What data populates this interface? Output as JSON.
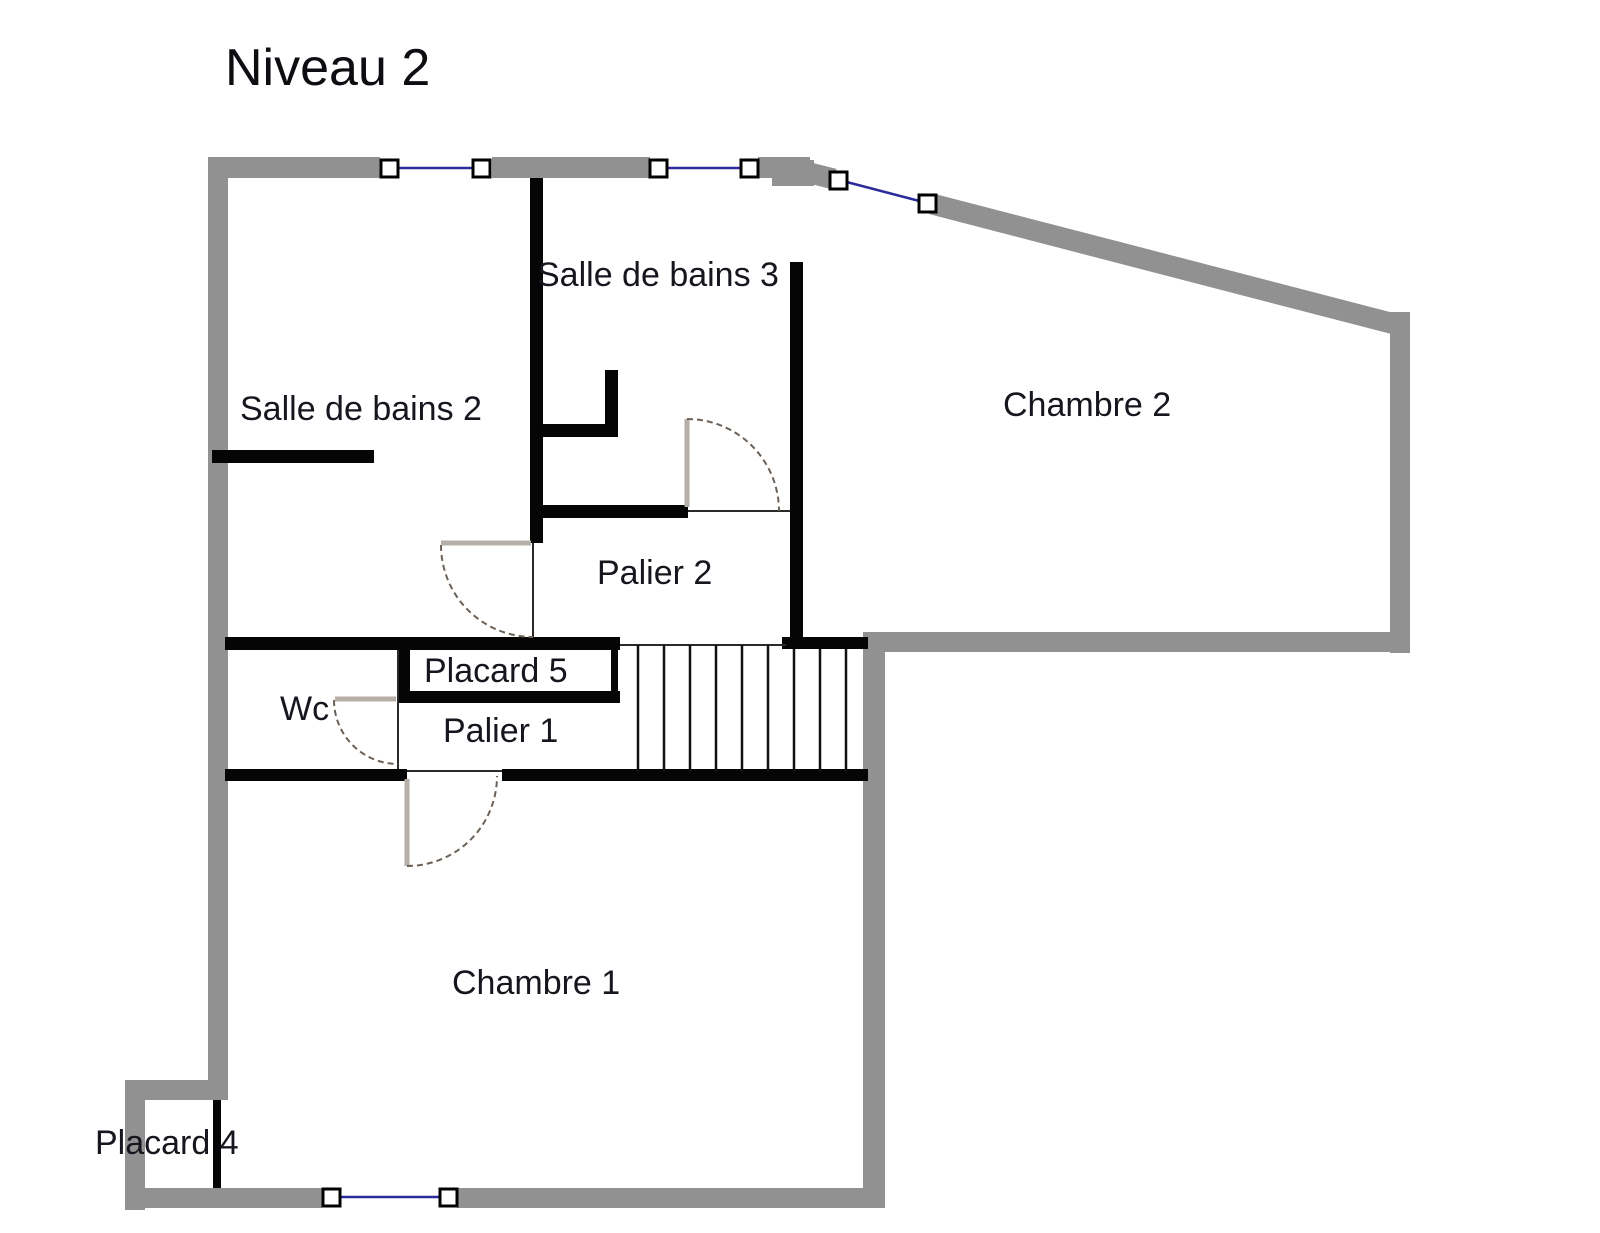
{
  "title": "Niveau 2",
  "floor_plan": {
    "rooms": {
      "salle_de_bains_2": "Salle de bains 2",
      "salle_de_bains_3": "Salle de bains 3",
      "chambre_2": "Chambre 2",
      "palier_2": "Palier 2",
      "placard_5": "Placard 5",
      "wc": "Wc",
      "palier_1": "Palier 1",
      "chambre_1": "Chambre 1",
      "placard_4": "Placard 4"
    },
    "features": {
      "windows": 4,
      "doors_with_swing": 4,
      "stair_treads": 9
    },
    "colors": {
      "outer_wall": "#919191",
      "interior_wall": "#050505",
      "window_line": "#2b2b9b",
      "door_leaf": "#b6afa7",
      "door_arc": "#6b6157",
      "label_text": "#16161e"
    }
  }
}
